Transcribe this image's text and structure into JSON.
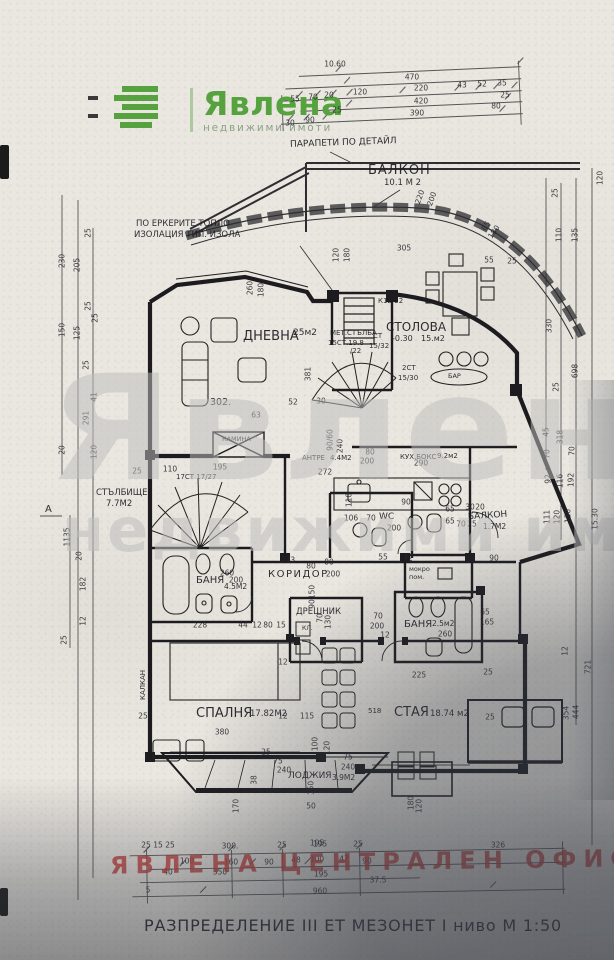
{
  "logo": {
    "brand": "Явлена",
    "tagline": "недвижими имоти",
    "green": "#55a23e"
  },
  "watermark": {
    "line1": "Явлена",
    "line2": "недвижими имоти"
  },
  "stamp": {
    "text": "ЯВЛЕНА ЦЕНТРАЛЕН ОФИС",
    "color": "#c33c37"
  },
  "title_block": "РАЗПРЕДЕЛЕНИЕ III ЕТ МЕЗОНЕТ I ниво М 1:50",
  "notes": {
    "parapet": "ПАРАПЕТИ ПО ДЕТАЙЛ",
    "insulation_1": "ПО ЕРКЕРИТЕ ТОПЛО",
    "insulation_2": "ИЗОЛАЦИЯ ТИП. ИЗОЛА",
    "kalkan": "КАЛКАН",
    "section_a": "А",
    "room_number": "302.",
    "kl": "КЛ.",
    "bar": "БАР",
    "stair_spiral": "17СТ 17/27",
    "stair_note_k": "К12/22",
    "stair_note_st": "СТ",
    "stair_note_st_v": "15/32",
    "stair_note_2st": "2СТ",
    "stair_note_2st_v": "15/30",
    "met_stair_1": "МЕТ.СТЪЛБА",
    "met_stair_2": "15СТ.19.8",
    "met_stair_3": "/22",
    "staya_num": "518"
  },
  "rooms": {
    "balkon_top": {
      "label": "БАЛКОН",
      "area": "10.1 М 2"
    },
    "dnevna": {
      "label": "ДНЕВНА",
      "area": "25м2"
    },
    "stolova": {
      "label": "СТОЛОВА",
      "level": "-0.30",
      "area": "15.м2"
    },
    "stalbishte": {
      "label": "СТЪЛБИЩЕ",
      "area": "7.7М2"
    },
    "antre": {
      "label": "АНТРЕ",
      "area": "4.4М2"
    },
    "kuhnya": {
      "label": "КУХ.БОКС",
      "area": "9.2м2"
    },
    "wc": {
      "label": "WC"
    },
    "mokro": {
      "label": "мокро",
      "label2": "пом."
    },
    "balkon_right": {
      "label": "БАЛКОН",
      "area": "1.7М2"
    },
    "banya_left": {
      "label": "БАНЯ",
      "area": "4.5М2"
    },
    "koridor": {
      "label": "КОРИДОР"
    },
    "dreshnik": {
      "label": "ДРЕШНИК"
    },
    "banya_right": {
      "label": "БАНЯ",
      "area": "2.5м2"
    },
    "kamina": {
      "label": "КАМИНА"
    },
    "spalnya": {
      "label": "СПАЛНЯ",
      "area": "17.82М2"
    },
    "staya": {
      "label": "СТАЯ",
      "area": "18.74 м2"
    },
    "lodzhiya": {
      "label": "ЛОДЖИЯ",
      "area": "3.9М2"
    }
  },
  "dim_labels": [
    {
      "t": "10.60",
      "x": 335,
      "y": 64
    },
    {
      "t": "470",
      "x": 412,
      "y": 77
    },
    {
      "t": "55",
      "x": 295,
      "y": 99
    },
    {
      "t": "70",
      "x": 313,
      "y": 97
    },
    {
      "t": "20",
      "x": 329,
      "y": 95
    },
    {
      "t": "120",
      "x": 360,
      "y": 92
    },
    {
      "t": "220",
      "x": 421,
      "y": 88
    },
    {
      "t": "43",
      "x": 462,
      "y": 85
    },
    {
      "t": "52",
      "x": 482,
      "y": 84
    },
    {
      "t": "35",
      "x": 502,
      "y": 83
    },
    {
      "t": "25",
      "x": 337,
      "y": 110
    },
    {
      "t": "420",
      "x": 421,
      "y": 101
    },
    {
      "t": "25",
      "x": 505,
      "y": 95
    },
    {
      "t": "30",
      "x": 290,
      "y": 123
    },
    {
      "t": "90",
      "x": 310,
      "y": 120
    },
    {
      "t": "390",
      "x": 417,
      "y": 113
    },
    {
      "t": "80",
      "x": 496,
      "y": 106
    },
    {
      "t": "120",
      "x": 336,
      "y": 255,
      "r": -90
    },
    {
      "t": "180",
      "x": 347,
      "y": 255,
      "r": -90
    },
    {
      "t": "220",
      "x": 420,
      "y": 197,
      "r": -70
    },
    {
      "t": "200",
      "x": 432,
      "y": 199,
      "r": -70
    },
    {
      "t": "85",
      "x": 486,
      "y": 226,
      "r": -55
    },
    {
      "t": "180",
      "x": 494,
      "y": 232,
      "r": -55
    },
    {
      "t": "55",
      "x": 489,
      "y": 260
    },
    {
      "t": "25",
      "x": 512,
      "y": 261
    },
    {
      "t": "305",
      "x": 404,
      "y": 248
    },
    {
      "t": "260",
      "x": 250,
      "y": 288,
      "r": -90
    },
    {
      "t": "180",
      "x": 261,
      "y": 290,
      "r": -90
    },
    {
      "t": "63",
      "x": 256,
      "y": 415
    },
    {
      "t": "52",
      "x": 293,
      "y": 402
    },
    {
      "t": "30",
      "x": 321,
      "y": 401
    },
    {
      "t": "381",
      "x": 308,
      "y": 374,
      "r": -90
    },
    {
      "t": "25",
      "x": 137,
      "y": 471
    },
    {
      "t": "110",
      "x": 170,
      "y": 469
    },
    {
      "t": "195",
      "x": 220,
      "y": 467
    },
    {
      "t": "200",
      "x": 367,
      "y": 461
    },
    {
      "t": "290",
      "x": 421,
      "y": 463
    },
    {
      "t": "80",
      "x": 370,
      "y": 452
    },
    {
      "t": "90/60",
      "x": 330,
      "y": 440,
      "r": -90
    },
    {
      "t": "240",
      "x": 340,
      "y": 446,
      "r": -90
    },
    {
      "t": "272",
      "x": 325,
      "y": 472
    },
    {
      "t": "106",
      "x": 351,
      "y": 518
    },
    {
      "t": "70",
      "x": 371,
      "y": 518
    },
    {
      "t": "200",
      "x": 394,
      "y": 528
    },
    {
      "t": "90",
      "x": 406,
      "y": 502
    },
    {
      "t": "110",
      "x": 349,
      "y": 500,
      "r": -90
    },
    {
      "t": "65",
      "x": 450,
      "y": 509
    },
    {
      "t": "30",
      "x": 470,
      "y": 507
    },
    {
      "t": "20",
      "x": 480,
      "y": 507
    },
    {
      "t": "65",
      "x": 450,
      "y": 521
    },
    {
      "t": "70",
      "x": 461,
      "y": 524
    },
    {
      "t": "25",
      "x": 472,
      "y": 524
    },
    {
      "t": "90",
      "x": 494,
      "y": 558
    },
    {
      "t": "55",
      "x": 383,
      "y": 557
    },
    {
      "t": "72",
      "x": 408,
      "y": 558
    },
    {
      "t": "243",
      "x": 288,
      "y": 560
    },
    {
      "t": "80",
      "x": 329,
      "y": 562
    },
    {
      "t": "80",
      "x": 311,
      "y": 566
    },
    {
      "t": "200",
      "x": 333,
      "y": 574
    },
    {
      "t": "150",
      "x": 312,
      "y": 592,
      "r": -90
    },
    {
      "t": "90",
      "x": 312,
      "y": 604,
      "r": -90
    },
    {
      "t": "70",
      "x": 320,
      "y": 618,
      "r": -90
    },
    {
      "t": "130",
      "x": 328,
      "y": 622,
      "r": -90
    },
    {
      "t": "70",
      "x": 378,
      "y": 616
    },
    {
      "t": "200",
      "x": 377,
      "y": 626
    },
    {
      "t": "12",
      "x": 385,
      "y": 635
    },
    {
      "t": "260",
      "x": 227,
      "y": 573
    },
    {
      "t": "200",
      "x": 236,
      "y": 580
    },
    {
      "t": "228",
      "x": 200,
      "y": 625
    },
    {
      "t": "44",
      "x": 243,
      "y": 625
    },
    {
      "t": "12",
      "x": 257,
      "y": 625
    },
    {
      "t": "80",
      "x": 268,
      "y": 625
    },
    {
      "t": "15",
      "x": 281,
      "y": 625
    },
    {
      "t": "260",
      "x": 445,
      "y": 634
    },
    {
      "t": "65",
      "x": 485,
      "y": 612
    },
    {
      "t": "165",
      "x": 487,
      "y": 622
    },
    {
      "t": "380",
      "x": 222,
      "y": 732
    },
    {
      "t": "25",
      "x": 143,
      "y": 716
    },
    {
      "t": "12",
      "x": 283,
      "y": 662
    },
    {
      "t": "12",
      "x": 283,
      "y": 716
    },
    {
      "t": "115",
      "x": 307,
      "y": 716
    },
    {
      "t": "100",
      "x": 315,
      "y": 744,
      "r": -90
    },
    {
      "t": "120",
      "x": 327,
      "y": 748,
      "r": -90
    },
    {
      "t": "225",
      "x": 419,
      "y": 675
    },
    {
      "t": "25",
      "x": 488,
      "y": 672
    },
    {
      "t": "25",
      "x": 490,
      "y": 717
    },
    {
      "t": "75",
      "x": 348,
      "y": 757
    },
    {
      "t": "240",
      "x": 348,
      "y": 767
    },
    {
      "t": "25",
      "x": 266,
      "y": 752
    },
    {
      "t": "75",
      "x": 278,
      "y": 761
    },
    {
      "t": "240",
      "x": 284,
      "y": 770
    },
    {
      "t": "38",
      "x": 254,
      "y": 780,
      "r": -90
    },
    {
      "t": "170",
      "x": 236,
      "y": 806,
      "r": -90
    },
    {
      "t": "150",
      "x": 311,
      "y": 788,
      "r": -90
    },
    {
      "t": "50",
      "x": 311,
      "y": 806
    },
    {
      "t": "195",
      "x": 317,
      "y": 843
    },
    {
      "t": "180",
      "x": 411,
      "y": 803,
      "r": -90
    },
    {
      "t": "120",
      "x": 419,
      "y": 806,
      "r": -90
    },
    {
      "t": "326",
      "x": 498,
      "y": 845
    },
    {
      "t": "25",
      "x": 146,
      "y": 845
    },
    {
      "t": "15",
      "x": 158,
      "y": 845
    },
    {
      "t": "25",
      "x": 170,
      "y": 845
    },
    {
      "t": "300.",
      "x": 230,
      "y": 846
    },
    {
      "t": "25",
      "x": 282,
      "y": 845
    },
    {
      "t": "195",
      "x": 320,
      "y": 844
    },
    {
      "t": "25",
      "x": 358,
      "y": 844
    },
    {
      "t": "100",
      "x": 187,
      "y": 861
    },
    {
      "t": "160",
      "x": 231,
      "y": 862
    },
    {
      "t": "90",
      "x": 269,
      "y": 862
    },
    {
      "t": "48",
      "x": 296,
      "y": 860
    },
    {
      "t": "100",
      "x": 317,
      "y": 859
    },
    {
      "t": "47",
      "x": 344,
      "y": 859
    },
    {
      "t": "90",
      "x": 367,
      "y": 861
    },
    {
      "t": "40",
      "x": 168,
      "y": 872
    },
    {
      "t": "350",
      "x": 220,
      "y": 872
    },
    {
      "t": "195",
      "x": 321,
      "y": 874
    },
    {
      "t": "37.5",
      "x": 378,
      "y": 880
    },
    {
      "t": "5",
      "x": 148,
      "y": 890
    },
    {
      "t": "960",
      "x": 320,
      "y": 891
    },
    {
      "t": "25",
      "x": 88,
      "y": 233,
      "r": -90
    },
    {
      "t": "230",
      "x": 62,
      "y": 261,
      "r": -90
    },
    {
      "t": "205",
      "x": 77,
      "y": 265,
      "r": -90
    },
    {
      "t": "25",
      "x": 88,
      "y": 306,
      "r": -90
    },
    {
      "t": "25",
      "x": 95,
      "y": 318,
      "r": -90
    },
    {
      "t": "150",
      "x": 62,
      "y": 330,
      "r": -90
    },
    {
      "t": "125",
      "x": 77,
      "y": 333,
      "r": -90
    },
    {
      "t": "25",
      "x": 86,
      "y": 365,
      "r": -90
    },
    {
      "t": "41",
      "x": 94,
      "y": 397,
      "r": -90
    },
    {
      "t": "291",
      "x": 86,
      "y": 418,
      "r": -90
    },
    {
      "t": "20",
      "x": 62,
      "y": 450,
      "r": -90
    },
    {
      "t": "120",
      "x": 94,
      "y": 452,
      "r": -90
    },
    {
      "t": "1135",
      "x": 67,
      "y": 537,
      "r": -90
    },
    {
      "t": "20",
      "x": 79,
      "y": 556,
      "r": -90
    },
    {
      "t": "182",
      "x": 83,
      "y": 584,
      "r": -90
    },
    {
      "t": "12",
      "x": 83,
      "y": 621,
      "r": -90
    },
    {
      "t": "25",
      "x": 64,
      "y": 640,
      "r": -90
    },
    {
      "t": "120",
      "x": 600,
      "y": 178,
      "r": -90
    },
    {
      "t": "25",
      "x": 555,
      "y": 193,
      "r": -90
    },
    {
      "t": "110",
      "x": 559,
      "y": 235,
      "r": -90
    },
    {
      "t": "135",
      "x": 575,
      "y": 235,
      "r": -90
    },
    {
      "t": "330",
      "x": 549,
      "y": 326,
      "r": -90
    },
    {
      "t": "25",
      "x": 556,
      "y": 387,
      "r": -90
    },
    {
      "t": "698",
      "x": 575,
      "y": 371,
      "r": -90
    },
    {
      "t": "45",
      "x": 546,
      "y": 432,
      "r": -90
    },
    {
      "t": "318",
      "x": 560,
      "y": 437,
      "r": -90
    },
    {
      "t": "70",
      "x": 547,
      "y": 454,
      "r": -90
    },
    {
      "t": "70",
      "x": 572,
      "y": 451,
      "r": -90
    },
    {
      "t": "92",
      "x": 548,
      "y": 479,
      "r": -90
    },
    {
      "t": "116",
      "x": 560,
      "y": 481,
      "r": -90
    },
    {
      "t": "192",
      "x": 571,
      "y": 480,
      "r": -90
    },
    {
      "t": "111",
      "x": 547,
      "y": 517,
      "r": -90
    },
    {
      "t": "120",
      "x": 557,
      "y": 517,
      "r": -90
    },
    {
      "t": "130",
      "x": 568,
      "y": 516,
      "r": -90
    },
    {
      "t": "15.30",
      "x": 595,
      "y": 519,
      "r": -90
    },
    {
      "t": "12",
      "x": 565,
      "y": 651,
      "r": -90
    },
    {
      "t": "721",
      "x": 588,
      "y": 667,
      "r": -90
    },
    {
      "t": "354",
      "x": 566,
      "y": 713,
      "r": -90
    },
    {
      "t": "444",
      "x": 576,
      "y": 712,
      "r": -90
    }
  ]
}
